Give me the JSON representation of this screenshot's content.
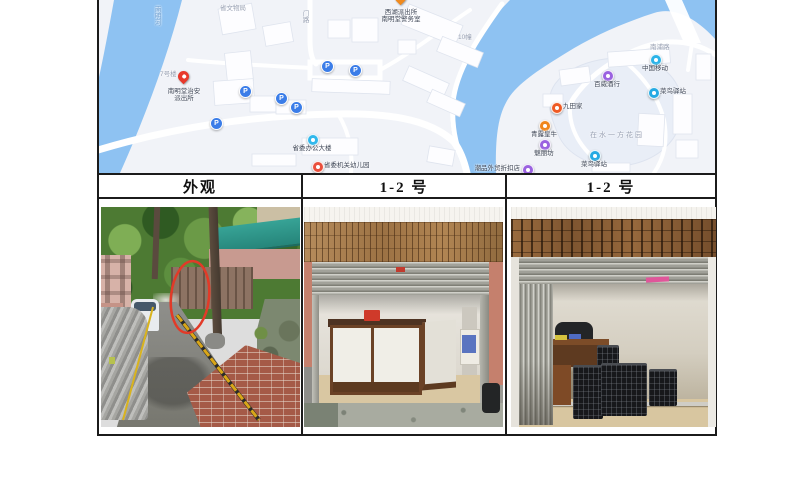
{
  "table": {
    "headers": [
      "外观",
      "1-2 号",
      "1-2 号"
    ]
  },
  "map": {
    "colors": {
      "river": "#8ec2f2",
      "land": "#f1f3f8",
      "building": "#fdfdff",
      "compound": "#e9eef7",
      "parking": "#3b7de8"
    },
    "area_labels": [
      {
        "text": "南明河",
        "x": 55,
        "y": 6,
        "cls": "water",
        "vertical": true
      },
      {
        "text": "省文物局",
        "x": 122,
        "y": 5,
        "cls": "dim"
      },
      {
        "text": "门路",
        "x": 203,
        "y": 10,
        "cls": "dim",
        "vertical": true
      },
      {
        "text": "7号楼",
        "x": 62,
        "y": 71,
        "cls": "dim"
      },
      {
        "text": "10幢",
        "x": 360,
        "y": 34,
        "cls": "dim"
      },
      {
        "text": "南浦路",
        "x": 552,
        "y": 44,
        "cls": "dim"
      },
      {
        "text": "在水一方花园",
        "x": 492,
        "y": 132,
        "cls": "estate"
      }
    ],
    "markers": [
      {
        "kind": "pin",
        "color": "#e8392c",
        "x": 86,
        "y": 82,
        "pos": "below",
        "name": "nanmingtang-police-pin",
        "lines": [
          "南明堂治安",
          "派出所"
        ]
      },
      {
        "kind": "pin",
        "color": "#f08a1e",
        "x": 303,
        "y": 3,
        "pos": "below",
        "name": "xihu-police-office-pin",
        "lines": [
          "西湖派出所",
          "南明堂警务室"
        ]
      },
      {
        "kind": "poi",
        "color": "#31b8ec",
        "x": 214,
        "y": 139,
        "pos": "below",
        "name": "gov-office-building-poi",
        "lines": [
          "省委办公大楼"
        ]
      },
      {
        "kind": "poi",
        "color": "#ea4f3c",
        "x": 219,
        "y": 166,
        "pos": "right",
        "name": "kindergarten-poi",
        "lines": [
          "省委机关幼儿园"
        ]
      },
      {
        "kind": "poi",
        "color": "#9a62e0",
        "x": 429,
        "y": 169,
        "pos": "left",
        "name": "outlet-store-poi",
        "lines": [
          "潮品外贸折扣店"
        ]
      },
      {
        "kind": "poi",
        "color": "#2bb3e8",
        "x": 557,
        "y": 59,
        "pos": "below",
        "name": "china-mobile-poi",
        "lines": [
          "中国移动"
        ]
      },
      {
        "kind": "poi",
        "color": "#25aae3",
        "x": 555,
        "y": 92,
        "pos": "right",
        "name": "cainiao-station-poi",
        "lines": [
          "菜鸟驿站"
        ]
      },
      {
        "kind": "poi",
        "color": "#9a62e0",
        "x": 509,
        "y": 75,
        "pos": "below",
        "name": "liquor-shop-poi",
        "lines": [
          "百威酒行"
        ]
      },
      {
        "kind": "poi",
        "color": "#ef5a24",
        "x": 458,
        "y": 107,
        "pos": "right",
        "name": "jiutianjia-poi",
        "lines": [
          "九田家"
        ]
      },
      {
        "kind": "poi",
        "color": "#f08519",
        "x": 446,
        "y": 125,
        "pos": "below",
        "name": "beef-restaurant-poi",
        "lines": [
          "青露皇牛"
        ]
      },
      {
        "kind": "poi",
        "color": "#9a62e0",
        "x": 446,
        "y": 144,
        "pos": "below",
        "name": "meilifang-poi",
        "lines": [
          "魅丽坊"
        ]
      },
      {
        "kind": "poi",
        "color": "#25aae3",
        "x": 496,
        "y": 155,
        "pos": "below",
        "name": "cainiao-station-2-poi",
        "lines": [
          "菜鸟驿站"
        ]
      }
    ],
    "parking": [
      {
        "x": 228,
        "y": 65
      },
      {
        "x": 256,
        "y": 69
      },
      {
        "x": 146,
        "y": 90
      },
      {
        "x": 182,
        "y": 97
      },
      {
        "x": 197,
        "y": 106
      },
      {
        "x": 117,
        "y": 122
      }
    ],
    "parking_glyph": "P"
  },
  "photos": [
    {
      "caption": "外观",
      "subject": "alley exterior with red oval annotation"
    },
    {
      "caption": "1-2 号",
      "subject": "shop front, roller shutter half open, white counter"
    },
    {
      "caption": "1-2 号",
      "subject": "shop front, folding gate, desk and black crates"
    }
  ]
}
